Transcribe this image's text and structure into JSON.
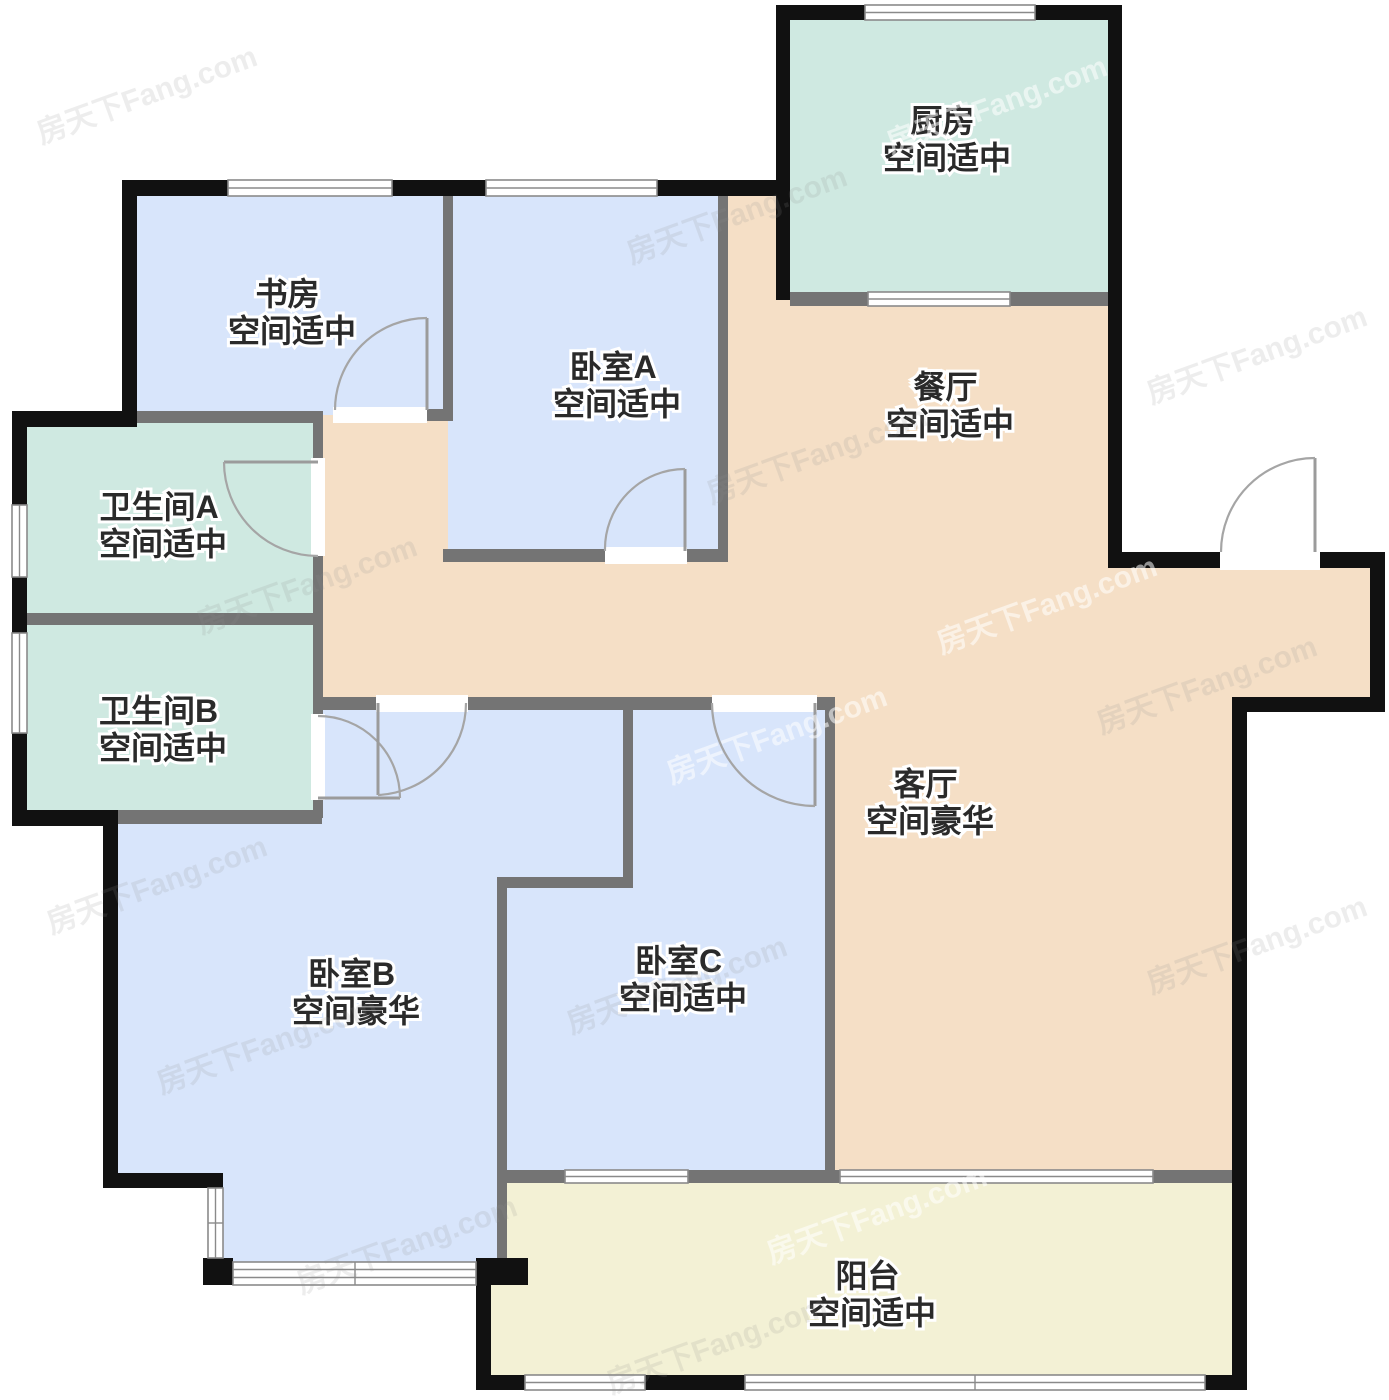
{
  "page": {
    "background": "#ffffff"
  },
  "watermark": {
    "text": "房天下Fang.com",
    "instances": [
      {
        "x": 30,
        "y": 70,
        "light": false
      },
      {
        "x": 620,
        "y": 190,
        "light": false
      },
      {
        "x": 880,
        "y": 80,
        "light": true
      },
      {
        "x": 1140,
        "y": 330,
        "light": false
      },
      {
        "x": 190,
        "y": 560,
        "light": false
      },
      {
        "x": 700,
        "y": 430,
        "light": false
      },
      {
        "x": 930,
        "y": 580,
        "light": true
      },
      {
        "x": 40,
        "y": 860,
        "light": false
      },
      {
        "x": 660,
        "y": 710,
        "light": true
      },
      {
        "x": 1090,
        "y": 660,
        "light": false
      },
      {
        "x": 150,
        "y": 1020,
        "light": false
      },
      {
        "x": 560,
        "y": 960,
        "light": false
      },
      {
        "x": 1140,
        "y": 920,
        "light": false
      },
      {
        "x": 290,
        "y": 1220,
        "light": false
      },
      {
        "x": 760,
        "y": 1190,
        "light": true
      },
      {
        "x": 600,
        "y": 1320,
        "light": false
      }
    ]
  },
  "floor_plan": {
    "rooms": [
      {
        "id": "study",
        "name": "书房",
        "desc": "空间适中",
        "color": "#d8e5fb"
      },
      {
        "id": "bedroom-a",
        "name": "卧室A",
        "desc": "空间适中",
        "color": "#d8e5fb"
      },
      {
        "id": "kitchen",
        "name": "厨房",
        "desc": "空间适中",
        "color": "#cfe9e1"
      },
      {
        "id": "dining",
        "name": "餐厅",
        "desc": "空间适中",
        "color": "#f5dfc6"
      },
      {
        "id": "bath-a",
        "name": "卫生间A",
        "desc": "空间适中",
        "color": "#cfe9e1"
      },
      {
        "id": "bath-b",
        "name": "卫生间B",
        "desc": "空间适中",
        "color": "#cfe9e1"
      },
      {
        "id": "living",
        "name": "客厅",
        "desc": "空间豪华",
        "color": "#f5dfc6"
      },
      {
        "id": "bedroom-b",
        "name": "卧室B",
        "desc": "空间豪华",
        "color": "#d8e5fb"
      },
      {
        "id": "bedroom-c",
        "name": "卧室C",
        "desc": "空间适中",
        "color": "#d8e5fb"
      },
      {
        "id": "balcony",
        "name": "阳台",
        "desc": "空间适中",
        "color": "#f3f1d5"
      }
    ],
    "wall_colors": {
      "exterior": "#111111",
      "interior": "#747474",
      "window": "#ffffff",
      "door": "#9b9b9b"
    }
  }
}
